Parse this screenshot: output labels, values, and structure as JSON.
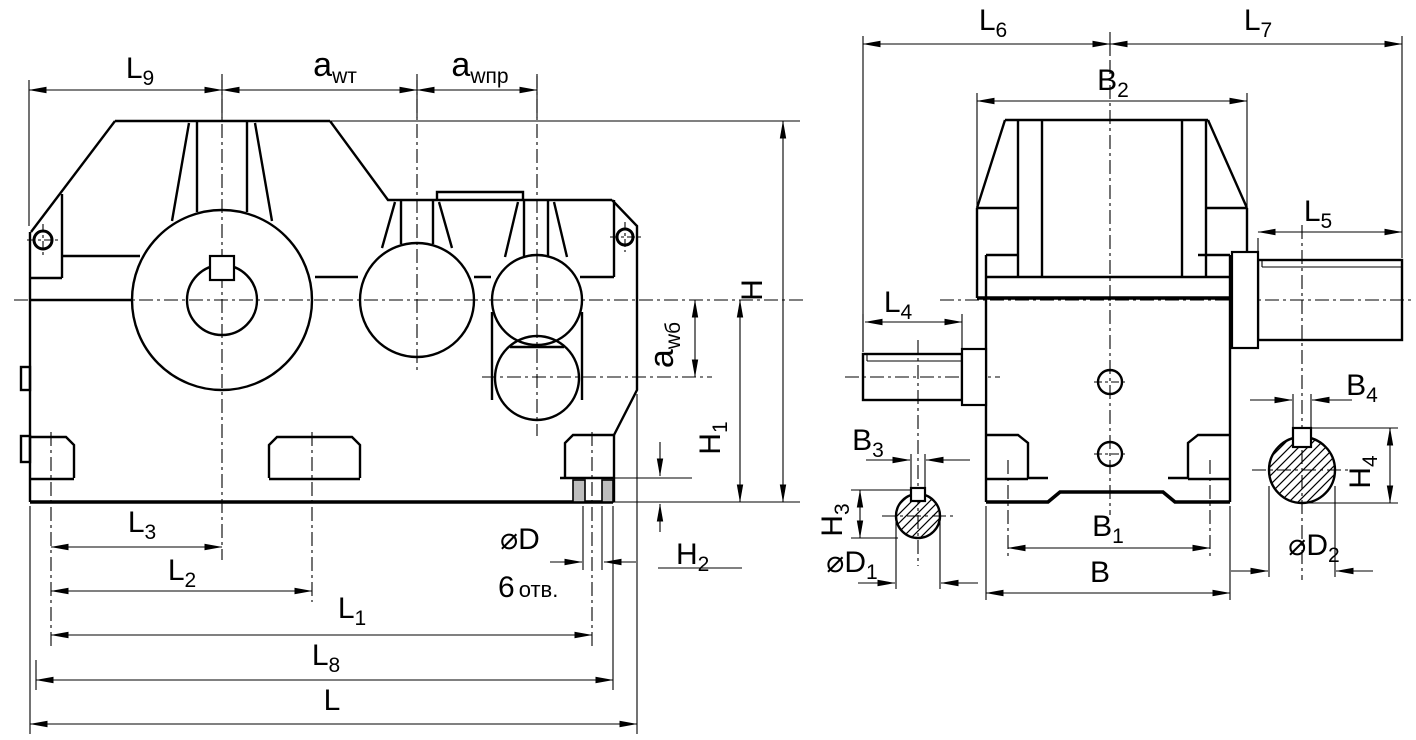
{
  "drawing": {
    "type": "engineering-outline-drawing",
    "views": [
      "front-view",
      "side-view"
    ]
  },
  "colors": {
    "line": "#000000",
    "background": "#ffffff",
    "section_fill": "#bdbdbd"
  },
  "labels": {
    "left": {
      "L9": {
        "main": "L",
        "sub": "9"
      },
      "awt": {
        "main": "a",
        "sub": "wт"
      },
      "awpr": {
        "main": "a",
        "sub": "wпр"
      },
      "awb": {
        "main": "a",
        "sub": "wб"
      },
      "H": {
        "main": "H",
        "sub": ""
      },
      "H1": {
        "main": "H",
        "sub": "1"
      },
      "H2": {
        "main": "H",
        "sub": "2"
      },
      "L3": {
        "main": "L",
        "sub": "3"
      },
      "L2": {
        "main": "L",
        "sub": "2"
      },
      "L1": {
        "main": "L",
        "sub": "1"
      },
      "L8": {
        "main": "L",
        "sub": "8"
      },
      "L": {
        "main": "L",
        "sub": ""
      },
      "dD": {
        "main": "⌀D",
        "sub": ""
      },
      "holes": {
        "main": "6",
        "sub": "отв."
      }
    },
    "right": {
      "L6": {
        "main": "L",
        "sub": "6"
      },
      "L7": {
        "main": "L",
        "sub": "7"
      },
      "B2": {
        "main": "B",
        "sub": "2"
      },
      "L5": {
        "main": "L",
        "sub": "5"
      },
      "L4": {
        "main": "L",
        "sub": "4"
      },
      "B3": {
        "main": "B",
        "sub": "3"
      },
      "H3": {
        "main": "H",
        "sub": "3"
      },
      "dD1": {
        "main": "⌀D",
        "sub": "1"
      },
      "B1": {
        "main": "B",
        "sub": "1"
      },
      "B": {
        "main": "B",
        "sub": ""
      },
      "B4": {
        "main": "B",
        "sub": "4"
      },
      "H4": {
        "main": "H",
        "sub": "4"
      },
      "dD2": {
        "main": "⌀D",
        "sub": "2"
      }
    }
  }
}
